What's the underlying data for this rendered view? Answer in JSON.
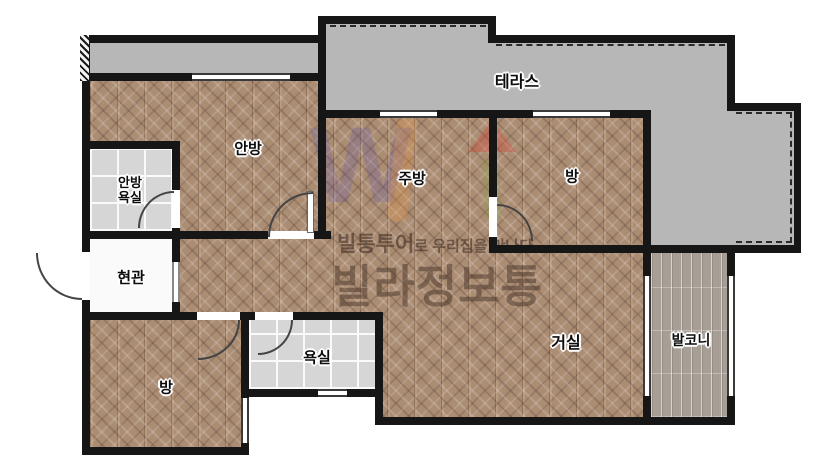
{
  "rooms": {
    "terrace": {
      "label": "테라스"
    },
    "master_bedroom": {
      "label": "안방"
    },
    "master_bathroom": {
      "label_line1": "안방",
      "label_line2": "욕실"
    },
    "kitchen": {
      "label": "주방"
    },
    "room_top_right": {
      "label": "방"
    },
    "entrance": {
      "label": "현관"
    },
    "living_room": {
      "label": "거실"
    },
    "balcony": {
      "label": "발코니"
    },
    "bathroom": {
      "label": "욕실"
    },
    "room_bottom_left": {
      "label": "방"
    }
  },
  "watermark": {
    "tagline_bold": "빌통투어",
    "tagline_rest": "로 우리집을 만나다",
    "brand": "빌라정보통"
  },
  "colors": {
    "wall": "#161616",
    "terrace_floor": "#b7b7b7",
    "wood_floor": "#ab8d74",
    "tile_floor": "#d6d6d6",
    "balcony_plank_floor": "#a79e95",
    "entrance_floor": "#fafafa"
  }
}
